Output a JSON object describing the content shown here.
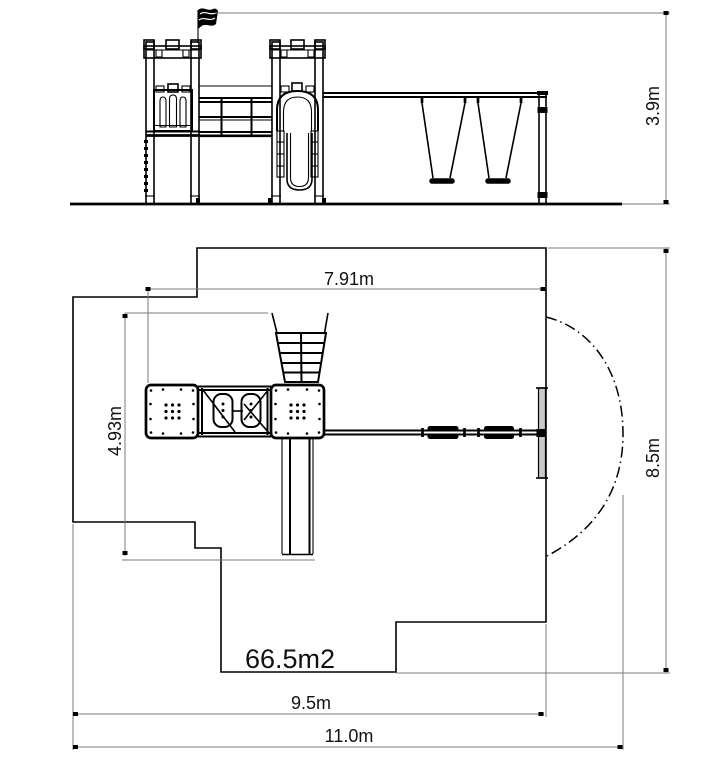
{
  "drawing": {
    "area_label": "66.5m2",
    "dimensions": {
      "height": "3.9m",
      "top_width": "7.91m",
      "left_depth": "4.93m",
      "right_height": "8.5m",
      "bottom_width": "9.5m",
      "total_width": "11.0m"
    },
    "colors": {
      "line": "#000000",
      "dimension_line": "#7b7b7b",
      "background": "#ffffff"
    }
  }
}
